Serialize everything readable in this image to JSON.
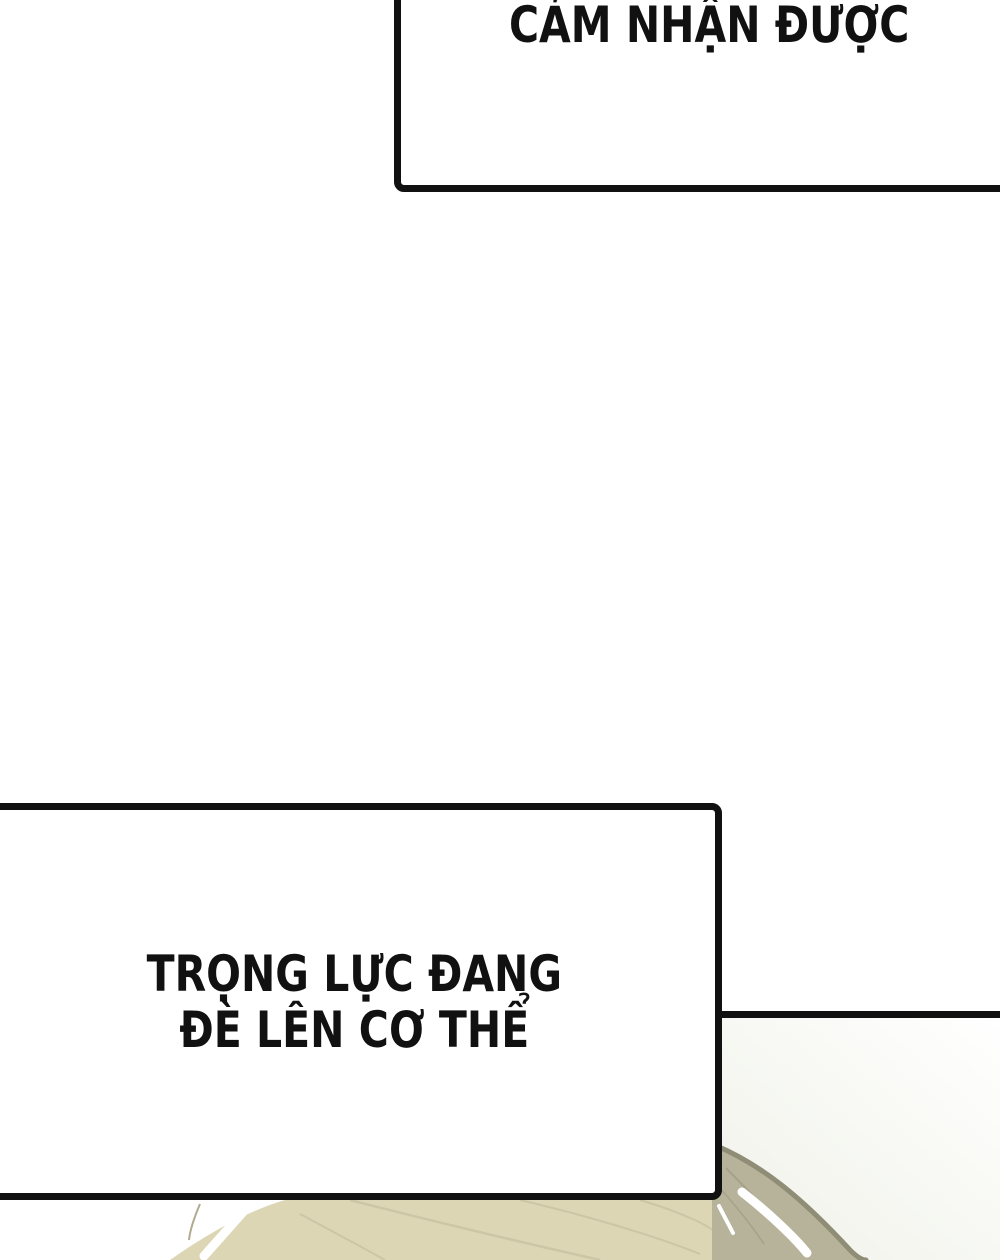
{
  "page": {
    "background": "#ffffff",
    "ink": "#111111"
  },
  "bubbles": {
    "top": {
      "text": "CẢM NHẬN ĐƯỢC"
    },
    "bottom": {
      "line1": "TRỌNG LỰC ĐANG",
      "line2": "ĐÈ LÊN CƠ THỂ"
    }
  },
  "artwork": {
    "subject": "top-of-head-with-pale-khaki-hair",
    "hair_light": "#dcd6b4",
    "hair_mid": "#b6b39a",
    "hair_outline": "#8f8d76",
    "hair_strand": "#ccc6a6",
    "hair_strand_dark": "#a5a289",
    "hair_strand_thin": "#b0ab8e",
    "panel_tint": "#eff1e7",
    "highlight": "#ffffff"
  }
}
